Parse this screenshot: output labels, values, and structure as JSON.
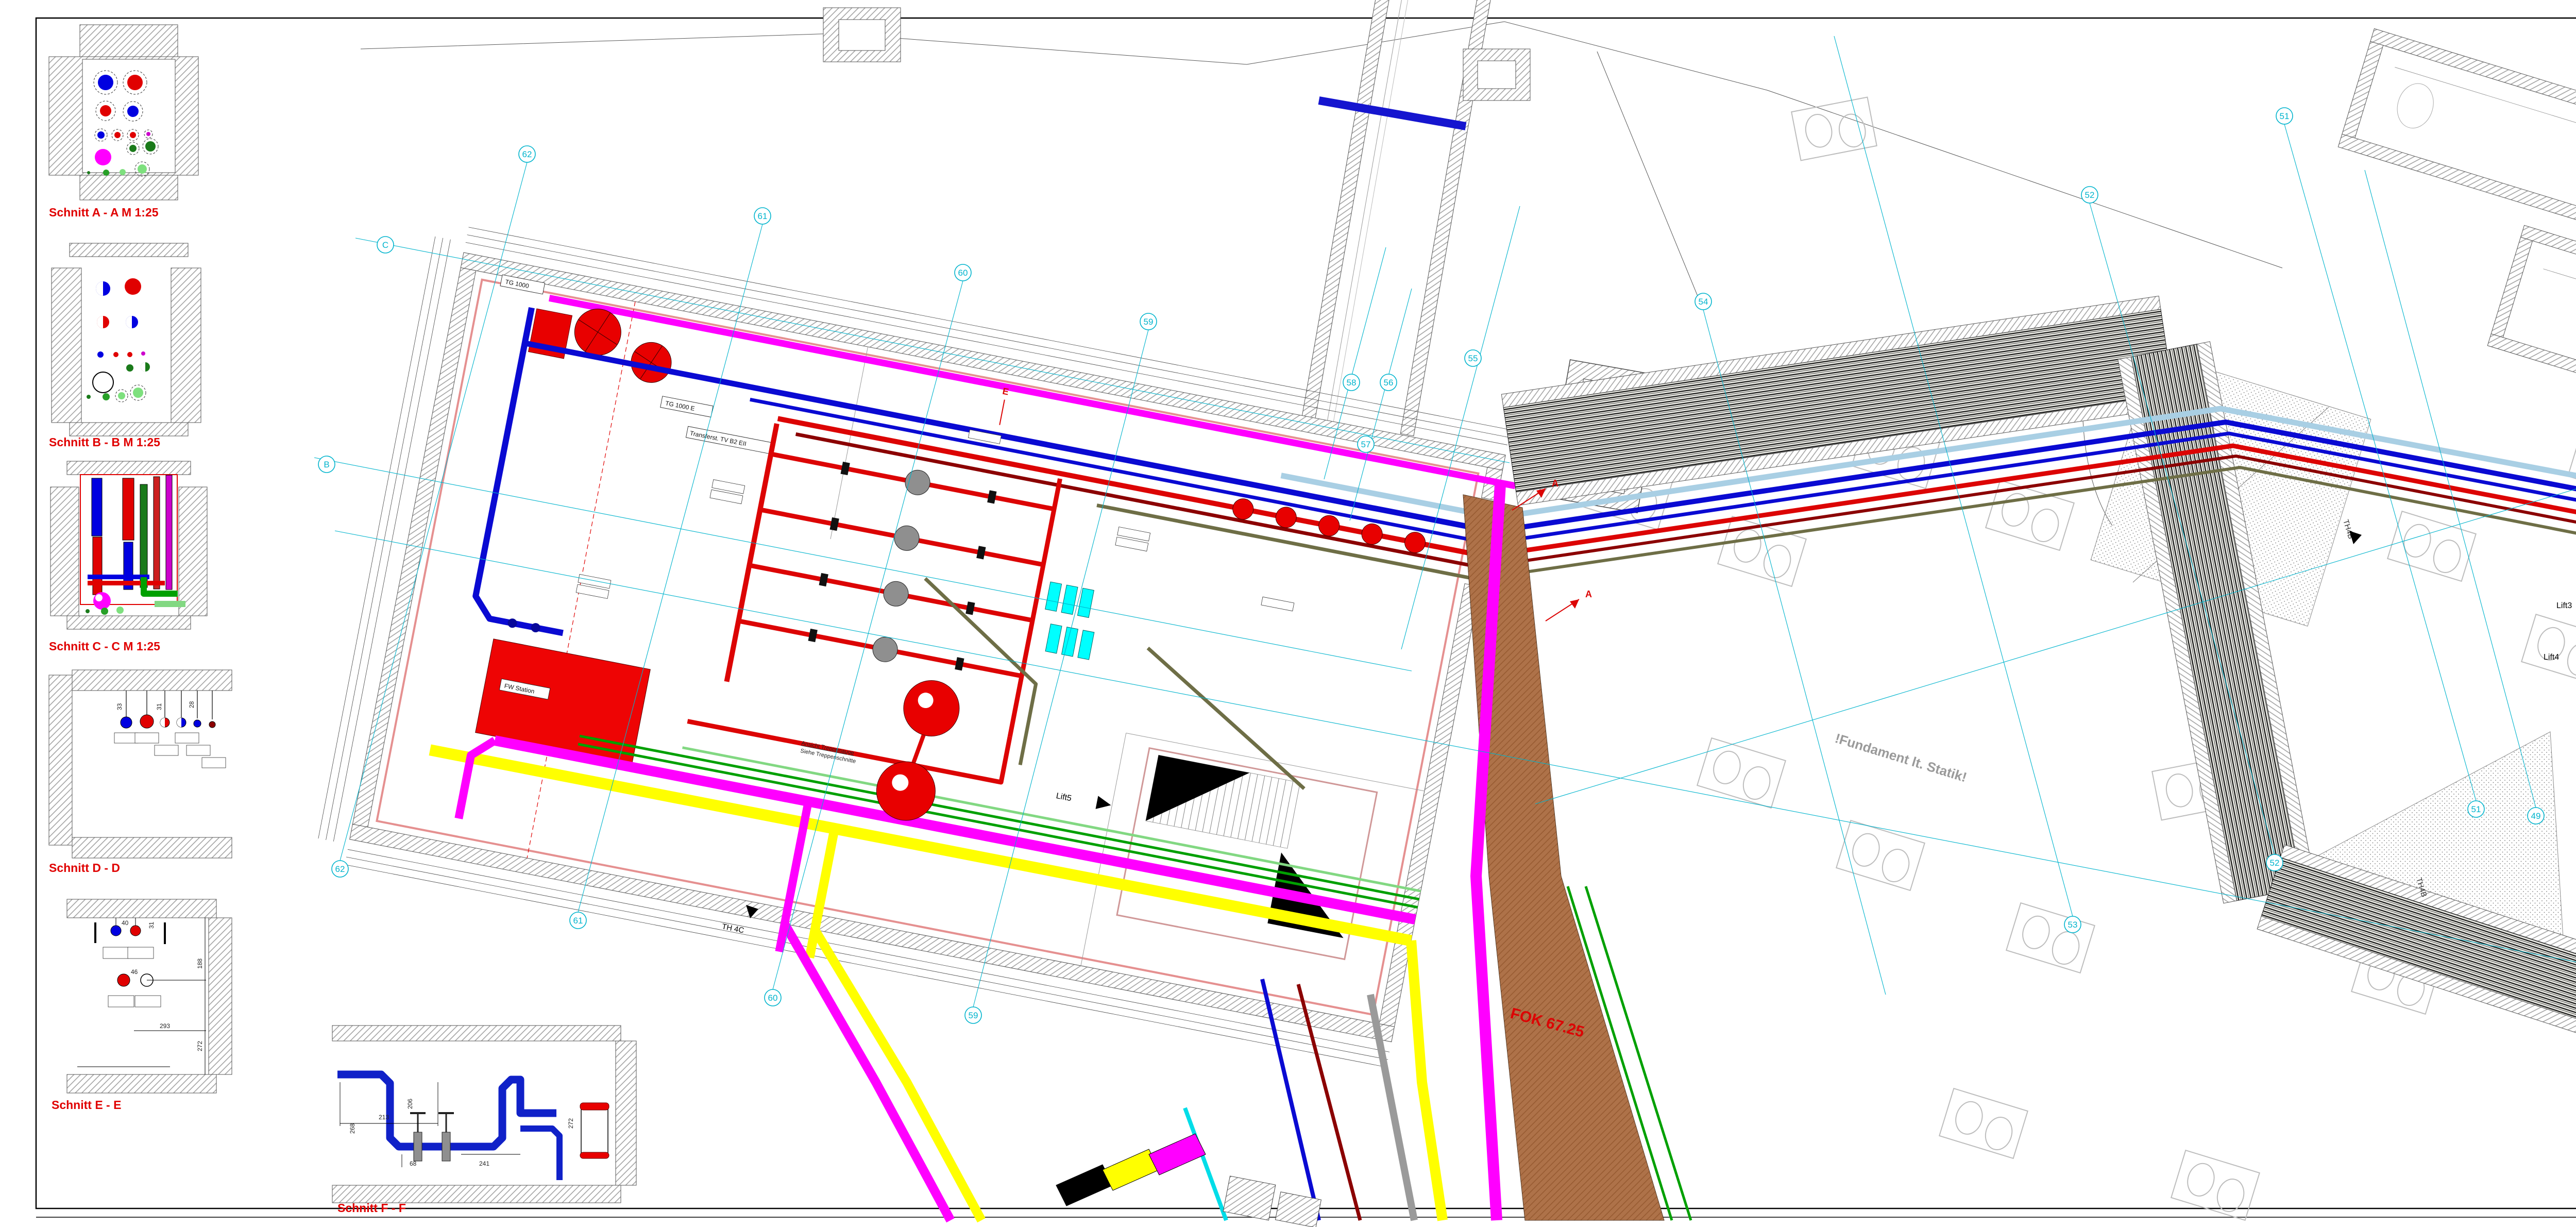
{
  "sheet": {
    "sections": {
      "a": "Schnitt A - A M 1:25",
      "b": "Schnitt B - B M 1:25",
      "c": "Schnitt C - C M 1:25",
      "d": "Schnitt D - D",
      "e": "Schnitt E - E",
      "f": "Schnitt F - F"
    },
    "section_dims": {
      "d": [
        "33",
        "31",
        "28"
      ],
      "e": [
        "40",
        "46",
        "31",
        "293",
        "188",
        "272"
      ],
      "f": [
        "213",
        "268",
        "206",
        "68",
        "241",
        "272"
      ]
    }
  },
  "plan": {
    "labels": {
      "tg1000": "TG 1000",
      "tg1000e": "TG 1000 E",
      "transfer": "Transferst. TV B2 EII",
      "fw_station": "FW Station",
      "lift3": "Lift3",
      "lift4": "Lift4",
      "lift5": "Lift5",
      "th4b": "TH4B",
      "th4c": "TH 4C",
      "fok": "FOK 67.25",
      "fundament": "!Fundament lt. Statik!",
      "treppe1": "Ansicht Treppenauge",
      "treppe2": "Siehe Treppenschnitte",
      "marker_a": "A",
      "marker_e": "E"
    },
    "grid_bubbles": {
      "c": "C",
      "b": "B",
      "n62": "62",
      "n61": "61",
      "n60": "60",
      "n59": "59",
      "n58": "58",
      "n57": "57",
      "n56": "56",
      "n55": "55",
      "n54": "54",
      "n53": "53",
      "n52": "52",
      "n51": "51",
      "n49": "49"
    }
  },
  "title_block": {
    "notes": {
      "general_title": "ALLGEMEINES",
      "general": [
        "Die Lage der Einbauten in den Decken (Luftauslässe, ULKG,...) sind den Deckenspiegelplänen zu entnehmen.",
        "Die Angaben aus den Wandansichten sind zu beachten.",
        "Im Bodenaufbau ist eine Querung der Gebäudedehnfugen mit Leitungen nicht zulässig.",
        "Im Deckenbereich ist eine Querung der Gebäudedehnfugen mit Leitungen nur mit entsprechenden Maßnahmen und in Absprache mit dem Architekten und dem Statiker erlaubt.",
        "Für die Anschlüsse der bauseits beigestellten Geräte (Medizintechnik, Küche, ...) sind die Detailpläne der entsprechenden Gewerke zu beachten."
      ],
      "sanitary_title": "ALLGEMEINES SANITÄR",
      "sanitary": [
        "In der Kaltwasserleitung ist am Ende der Verteilleitung ein Spülventil installiert, welches in Abhängigkeit der Zeit und der Temperatur eine automatische Spülung der Leitung durchführt.",
        "Warmwasserleitungen werden bis zur Entnahme durchgeschliffen.",
        "Jedes Bad bzw. jeder Raum wird mit Unterputzabsperrventile ausgestattet."
      ],
      "heating_title": "ALLGEMEINES HEIZUNG",
      "heating": [
        "Die Anbindung der Heizkörper erfolgt vom darunterliegenden Geschoß.",
        "Verbindungsstellen im Bodenaufbau sind zu vermeiden.",
        "Die Verlegung der Fußbodenheizung ist im Bezug auf die Estrichdehnfugen mit dem Estrichleger abzustimmen.",
        "Bei der Querung der Estrichdehnfugen sind Schutzrohre vorzusehen."
      ]
    },
    "revision": {
      "filled": {
        "index": "V01",
        "datum": "x",
        "gezeichnet": "x",
        "aenderung": "zur Prüfung"
      },
      "headers": [
        "Index",
        "Datum",
        "Gezeichn.",
        "Änderung"
      ]
    },
    "elektro_row": "PLANGRUNDLAGE ELEKTRO-MED",
    "elektro_value": "x",
    "bauherr": {
      "label": "BAUHERR",
      "name": "KRAGES Burgenländische Krankenanstalten-Ges.m.b.H.",
      "address": "A-7000 Eisenstadt  Josef Hyrtl Platz 4",
      "contact": "T 057979-3000      F 057979-5306      E direktion@krages.at"
    },
    "projekt": {
      "label": "PROJEKT",
      "title": "NEUBAU KH OBERWART"
    },
    "generalplaner": {
      "label": "GENERALPLANER",
      "name": "ARGE EDERER+HAGHIRIAN, GENERALPLAN GMBH",
      "address": "A-8010 Graz   Schießstattgasse 58",
      "contact": "T 0316-682876      F 0316-823951      E office@keh.at"
    },
    "plangrundlage1": {
      "label": "PLANGRUNDLAGE",
      "value": "K4N_ARC_AF_GR_2U_FINGER4NORD_A07"
    },
    "planverfasser": {
      "label": "PLANVERFASSER",
      "name": "Dipl. Ing. Anton Hofstätter Gesellschaft m.b.H.",
      "line1": "Gebäudetechnik - Anlagentechnik",
      "line2": "8054 Seiersberg-Pirka  Weischweg 8",
      "line3": "office@heiz-hofstaetter.at        T +43 316 715656-0",
      "logo_h": "h",
      "logo_text": "heiz-hofstätter",
      "logo_sub": "Gebäudetechnik  Anlagentechnik"
    },
    "fachplaner": {
      "label": "FACHPLANER",
      "name": "Ingenieurbüro Lang GmbH",
      "addr1": "Eisteichgasse  41",
      "addr2": "8010  Graz",
      "tel": "Tel      +43 316 471537",
      "fax": "FAX    +43 316 471537-3",
      "mail": "e-mail  office@iblang.at"
    },
    "plangrundlage2": {
      "label": "PLANGRUNDLAGE",
      "value": "K4N_HKL_AF_GR_2U_FINGER4NORDHSK_A06"
    },
    "lageplan_label": "LAGEPLAN",
    "bauteil_label": "BAUTEIL",
    "bauteil_numbers": [
      "7",
      "6",
      "5",
      "4",
      "3",
      "2",
      "1"
    ],
    "compass": {
      "n": "N",
      "s": "S"
    },
    "planart": {
      "label": "PLANART",
      "value": "MONTAGEPLAN"
    },
    "planinhalt": {
      "label": "PLANINHALT",
      "line1": "GRUNDRISS UG02",
      "line2": "FINGER 4 NORD - HKLS"
    },
    "massstab": {
      "label": "Maßstab",
      "value": "1 : 50"
    },
    "table": {
      "headers": [
        "Name",
        "Datum",
        "Plangröße",
        "Sparte",
        "PHASE",
        "INDEX"
      ],
      "row1_label": "GEZEICHNET",
      "row1_name": "AR",
      "row1_datum": "06.10.2021",
      "row2_label": "GEPRÜFT",
      "row2_name": "AR",
      "row2_datum": "14.10.2021",
      "plangroesse": "1722x841",
      "sparte": "HKL",
      "phase": "WM",
      "index": "V01"
    },
    "plot_file": "Plot-Datei: K4N_HKL_WM_GR_2U_FINGER4NORDHK_V01.PDF"
  }
}
